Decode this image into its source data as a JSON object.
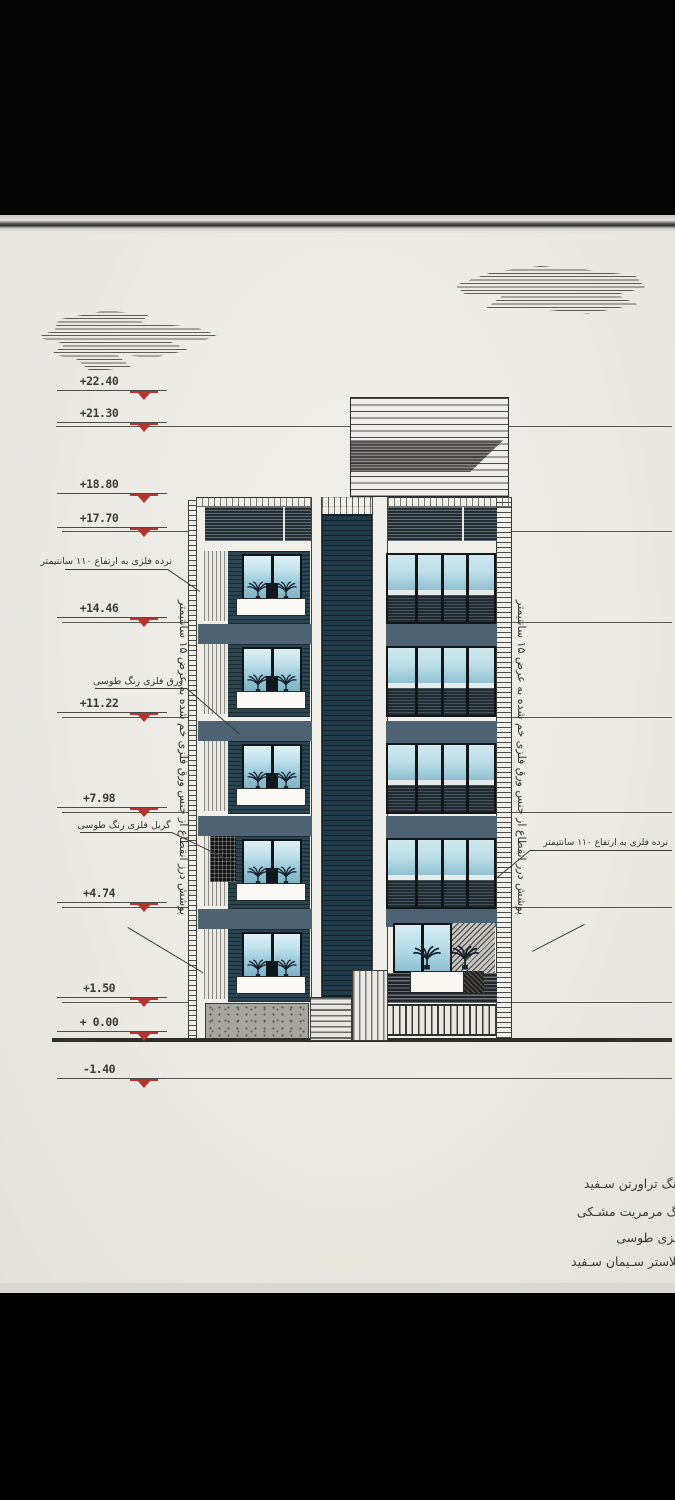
{
  "drawing": {
    "kind": "residential building front elevation (architectural drawing photo)"
  },
  "levels": [
    {
      "label": "+22.40"
    },
    {
      "label": "+21.30"
    },
    {
      "label": "+18.80"
    },
    {
      "label": "+17.70"
    },
    {
      "label": "+14.46"
    },
    {
      "label": "+11.22"
    },
    {
      "label": "+7.98"
    },
    {
      "label": "+4.74"
    },
    {
      "label": "+1.50"
    },
    {
      "label": "+ 0.00"
    },
    {
      "label": "-1.40"
    }
  ],
  "annotations": {
    "railing_left": "نرده فلزی به ارتفاع ۱۱۰ سانتیمتر",
    "metal_sheet": "ورق فلزی رنگ طوسی",
    "metal_grille": "گریل فلزی رنگ طوسی",
    "railing_right": "نرده فلزی به ارتفاع ۱۱۰ سانتیمتر",
    "expansion_joint_left": "پوشش درز انقطاع از جنس ورق فلزی خم شده به عرض ۱۵ سانتیمتر",
    "expansion_joint_right": "پوشش درز انقطاع از جنس ورق فلزی خم شده به عرض ۱۵ سانتیمتر"
  },
  "legend": {
    "items": [
      {
        "label": "سنگ تراورتن سـفید"
      },
      {
        "label": "سنگ مرمریت مشـکی"
      },
      {
        "label": "ورق فلزی طوسی"
      },
      {
        "label": "پلاستر سـیمان سـفید"
      }
    ]
  },
  "colors": {
    "marker_red": "#b23530",
    "glass_dark_blue": "#203c4b",
    "spandrel_slate": "#4d6374",
    "sky_reflection": "#bfe2ec",
    "paper": "#eceae4"
  }
}
